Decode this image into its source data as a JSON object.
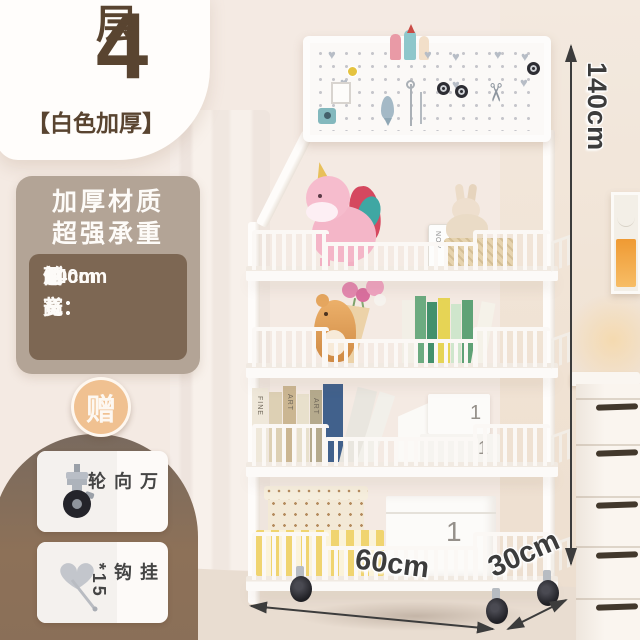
{
  "product_card": {
    "tier_count": "4",
    "tier_unit": "层",
    "variant": "【白色加厚】"
  },
  "feature_box": {
    "title_line1": "加厚材质",
    "title_line2": "超强承重",
    "specs": [
      {
        "label": "面长：",
        "value": "60cm"
      },
      {
        "label": "侧宽：",
        "value": "30cm"
      },
      {
        "label": "总高：",
        "value": "140cm"
      }
    ]
  },
  "gifts": {
    "badge": "赠",
    "items": [
      {
        "label": "万向轮"
      },
      {
        "label": "挂钩*15"
      }
    ]
  },
  "dimension_labels": {
    "height": "140cm",
    "width": "60cm",
    "depth": "30cm"
  },
  "shelf_scene": {
    "calendar": {
      "month": "NOV",
      "day": "05"
    },
    "box_label_mid": "1",
    "box_label_low": "1",
    "box_label_bottom": "1",
    "book_text_fine": "FINE",
    "book_text_art": "ART"
  },
  "icons": {
    "scissors": "✂",
    "heart": "♥"
  },
  "colors": {
    "accent_brown": "#594430",
    "panel_tan": "#b3a496",
    "panel_brown": "#7d6753",
    "arch_brown": "#8a6f58",
    "badge_orange": "#f0c191",
    "arrow_dark": "#3c3c3c",
    "shelf_white": "#faf7f4"
  }
}
